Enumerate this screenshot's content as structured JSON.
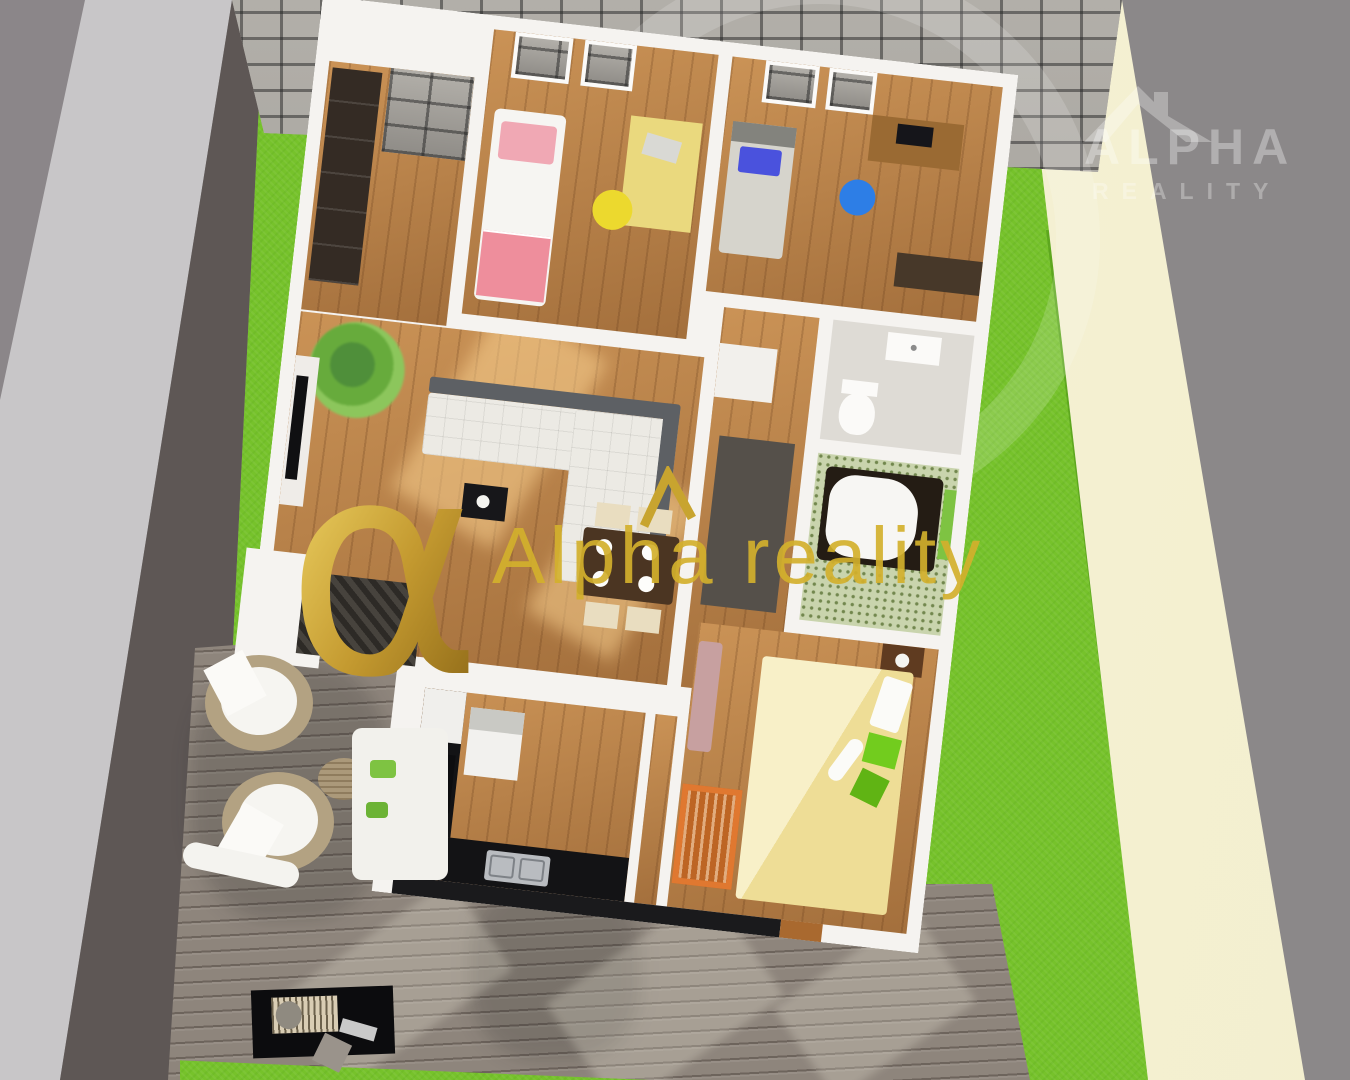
{
  "scene": {
    "description": "Aerial 3D rendering of a single-storey house floor plan with garden, paved courtyard and wooden terrace",
    "environment": {
      "areas": [
        {
          "name": "road",
          "color": "#8b8689"
        },
        {
          "name": "sidewalk",
          "color": "#c8c6c8"
        },
        {
          "name": "curb-strip",
          "color": "#5e5755"
        },
        {
          "name": "lawn",
          "color": "#76c22b"
        },
        {
          "name": "lawn-shadow",
          "color": "#58a01c"
        },
        {
          "name": "paved-courtyard",
          "color": "#a5a29c"
        },
        {
          "name": "garden-path",
          "color": "#f5f1d4"
        },
        {
          "name": "wooden-terrace",
          "color": "#8e857c"
        },
        {
          "name": "backdrop",
          "color": "#8b8889"
        }
      ]
    },
    "house": {
      "wall_color": "#f5f3f0",
      "floor_wood_color": "#b67c43",
      "rooms": [
        {
          "name": "entry-hall",
          "furniture": [
            "wardrobe"
          ]
        },
        {
          "name": "bedroom-1",
          "furniture": [
            "single-bed-pink",
            "desk-yellow",
            "chair-yellow"
          ]
        },
        {
          "name": "bedroom-2",
          "furniture": [
            "single-bed-blue-pillow",
            "desk-with-monitor",
            "office-chair-blue",
            "sideboard"
          ]
        },
        {
          "name": "living-room",
          "furniture": [
            "palm-plant",
            "tv-unit",
            "corner-sofa-white-gray",
            "coffee-table",
            "dining-table",
            "dining-chairs-4",
            "plates-4"
          ]
        },
        {
          "name": "hallway",
          "furniture": [
            "cabinet",
            "dark-runner-rug"
          ]
        },
        {
          "name": "wc",
          "furniture": [
            "washbasin",
            "toilet"
          ]
        },
        {
          "name": "bathroom",
          "furniture": [
            "bathtub-dark-surround",
            "green-window"
          ]
        },
        {
          "name": "kitchen",
          "furniture": [
            "black-counter",
            "double-sink",
            "cooktop",
            "fridge",
            "island"
          ]
        },
        {
          "name": "master-bedroom",
          "furniture": [
            "double-bed-yellow",
            "green-pillows",
            "white-roll-pillow",
            "nightstand-with-lamp",
            "baby-crib-orange",
            "loveseat-mauve"
          ]
        }
      ]
    },
    "terrace": {
      "furniture": [
        "round-lounge-chair",
        "round-lounge-chair",
        "rattan-side-table",
        "outdoor-sofa-white",
        "roll-cushion",
        "barbecue-grill"
      ]
    }
  },
  "watermarks": {
    "corner": {
      "line1": "ALPHA",
      "line2": "REALITY",
      "icon": "roof-icon",
      "color": "rgba(255,255,255,0.33)"
    },
    "center": {
      "symbol": "α",
      "text": "Alpha reality",
      "icon": "roof-caret-icon",
      "color_gold": "#d2b02d"
    }
  }
}
